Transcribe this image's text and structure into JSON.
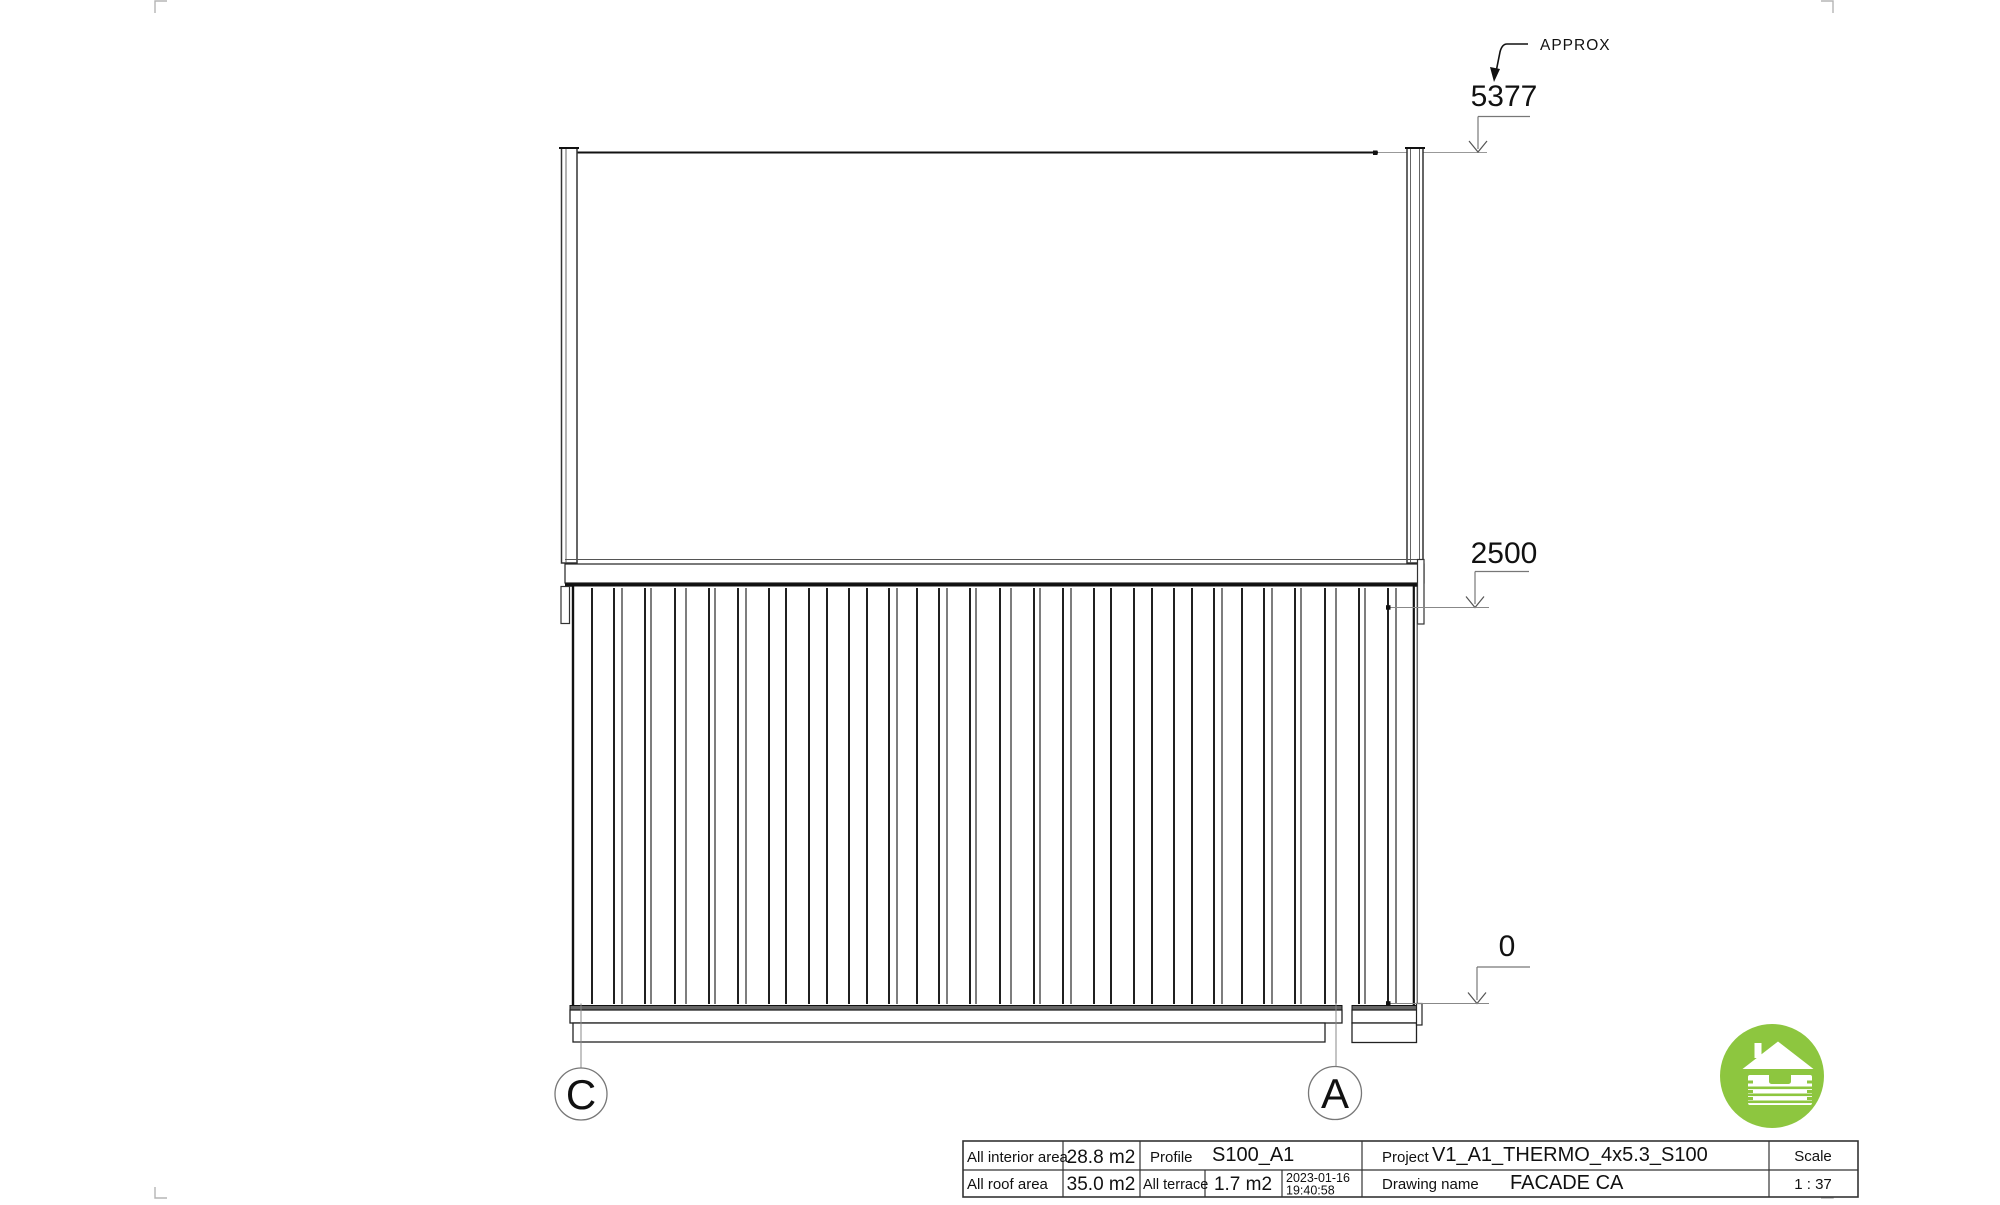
{
  "drawing": {
    "dimensions": {
      "top": {
        "value": "5377",
        "note": "APPROX"
      },
      "mid": {
        "value": "2500"
      },
      "base": {
        "value": "0"
      }
    },
    "grid_markers": {
      "left": "C",
      "right": "A"
    }
  },
  "title_block": {
    "interior_area_label": "All interior area",
    "interior_area_value": "28.8 m2",
    "profile_label": "Profile",
    "profile_value": "S100_A1",
    "project_label": "Project",
    "project_value": "V1_A1_THERMO_4x5.3_S100",
    "roof_area_label": "All roof area",
    "roof_area_value": "35.0 m2",
    "terrace_label": "All terrace",
    "terrace_value": "1.7 m2",
    "date_line1": "2023-01-16",
    "date_line2": "19:40:58",
    "drawing_name_label": "Drawing name",
    "drawing_name_value": "FACADE CA",
    "scale_label": "Scale",
    "scale_value": "1 : 37"
  },
  "logo": {
    "color": "#8dc63f",
    "icon": "log-cabin-house-icon"
  }
}
